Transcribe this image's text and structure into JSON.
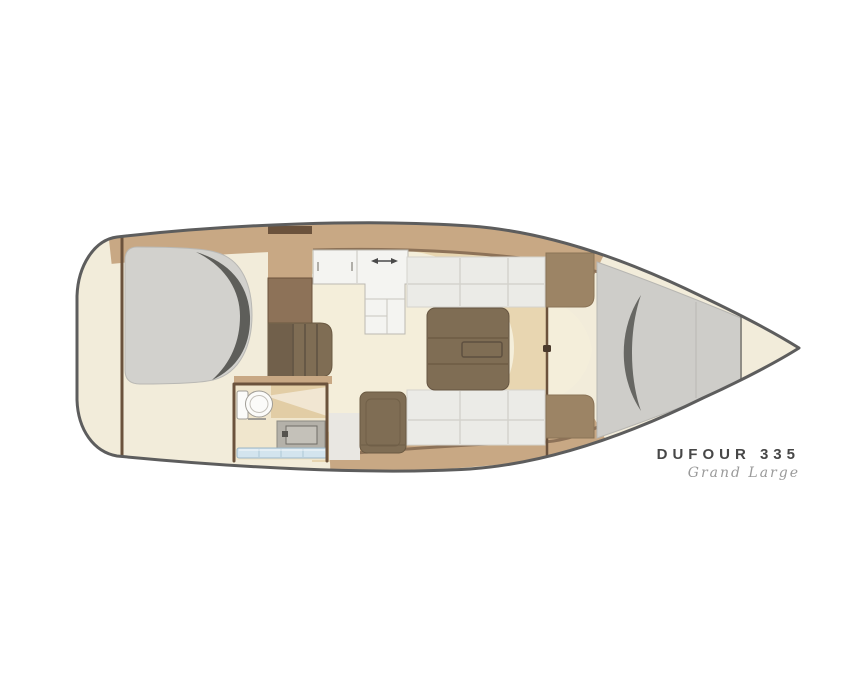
{
  "branding": {
    "model": "DUFOUR 335",
    "edition": "Grand Large"
  },
  "areas": [
    "aft-cabin",
    "head",
    "galley",
    "companionway-steps",
    "salon",
    "chart-table-seat",
    "forward-cabin",
    "v-berth",
    "anchor-locker"
  ],
  "colors": {
    "background": "#ffffff",
    "hull_fill": "#f2ecda",
    "hull_outline": "#5d5d5d",
    "deck_band": "#c8a884",
    "trim_dark": "#6b523c",
    "wood_mid": "#8d7258",
    "wood_block": "#9c8465",
    "furniture_brown": "#7f6d54",
    "floor_beige": "#e8d6b1",
    "floor_light": "#f4eeda",
    "counter_white": "#f4f4f1",
    "settee_gray": "#ebebe7",
    "berth_gray": "#d2d1cd",
    "berth_shadow": "#5e5e5a",
    "vberth_gray": "#cecdc9",
    "head_floor": "#f0e6cd",
    "head_counter": "#e2cda5",
    "sink_gray": "#b4b1a9",
    "sink_inner": "#c4c1b9",
    "shelf_blue": "#d3e4ee",
    "toilet_white": "#fbfbf9",
    "arrow_gray": "#4a4a4a",
    "text_dark": "#474747",
    "text_script": "#9a9a9a"
  }
}
